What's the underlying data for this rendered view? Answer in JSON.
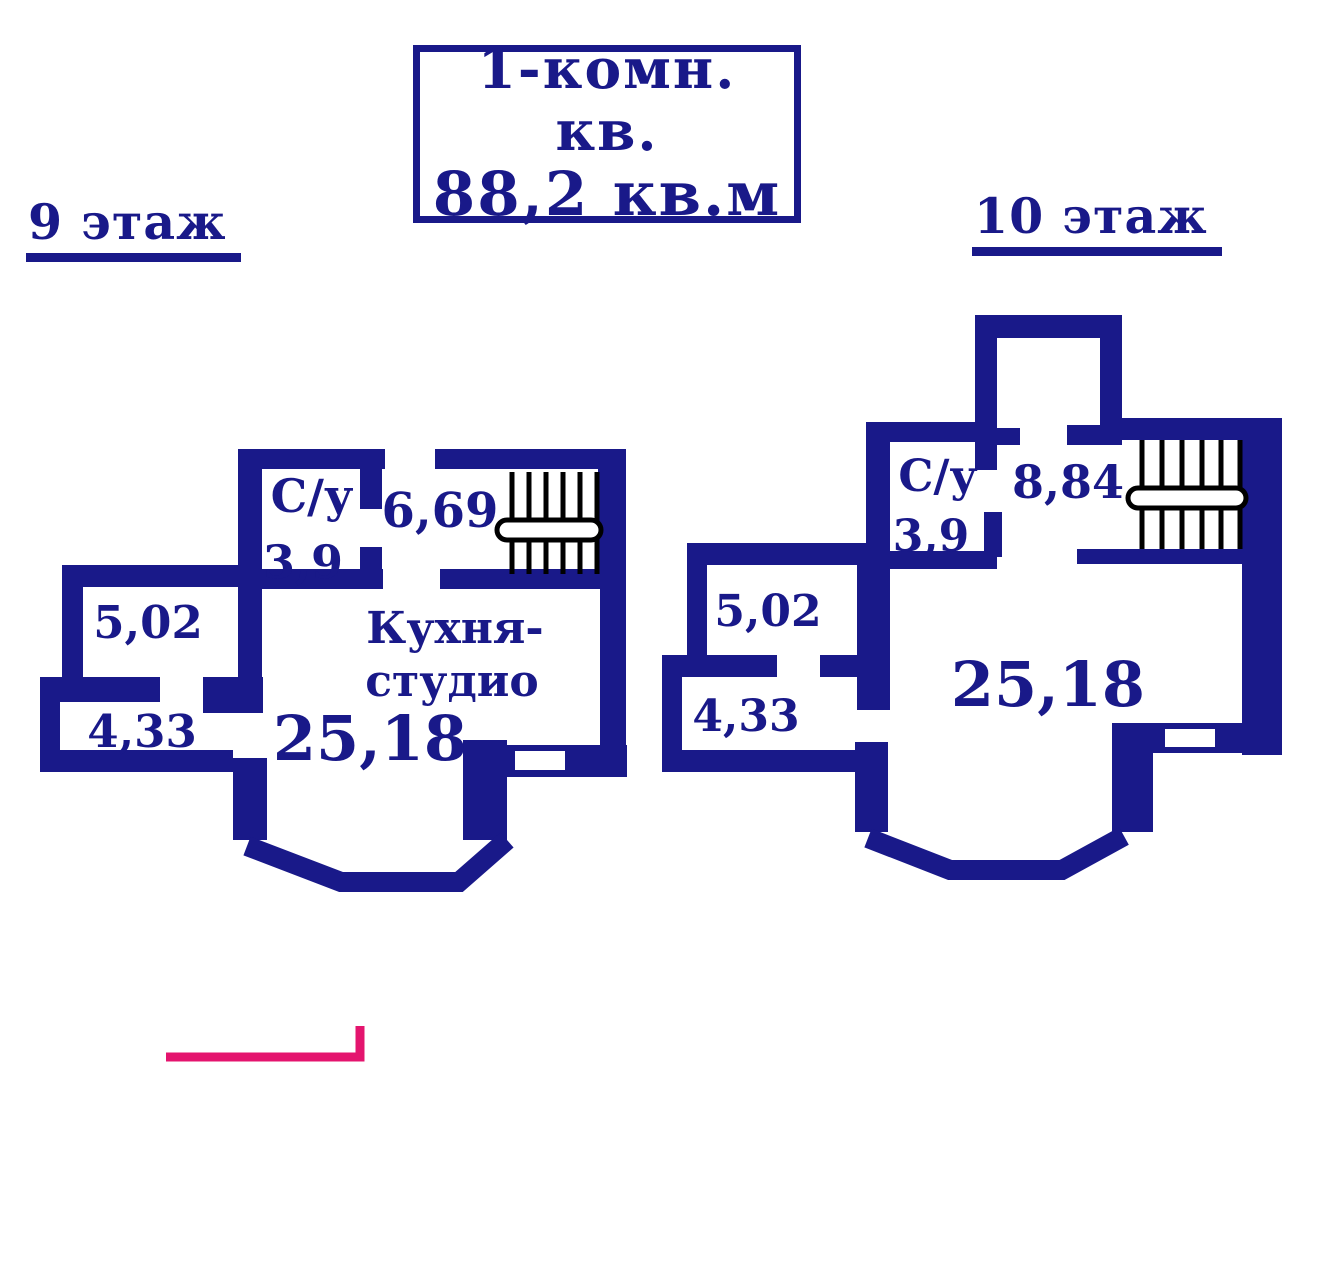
{
  "title_box": {
    "line1": "1-комн. кв.",
    "line2": "88,2 кв.м"
  },
  "floors": {
    "left": {
      "label": "9 этаж",
      "rooms": {
        "bathroom_abbr": "С/у",
        "bathroom_area": "3,9",
        "hall_area": "6,69",
        "room_upper_left_area": "5,02",
        "room_lower_left_area": "4,33",
        "kitchen_line1": "Кухня-",
        "kitchen_line2": "студио",
        "kitchen_area": "25,18"
      }
    },
    "right": {
      "label": "10 этаж",
      "rooms": {
        "bathroom_abbr": "С/у",
        "bathroom_area": "3,9",
        "hall_area": "8,84",
        "room_upper_left_area": "5,02",
        "room_lower_left_area": "4,33",
        "main_area": "25,18"
      }
    }
  },
  "colors": {
    "wall_and_text": "#191989",
    "stairs": "#000000",
    "accent_line": "#e4146e",
    "background": "#ffffff"
  }
}
